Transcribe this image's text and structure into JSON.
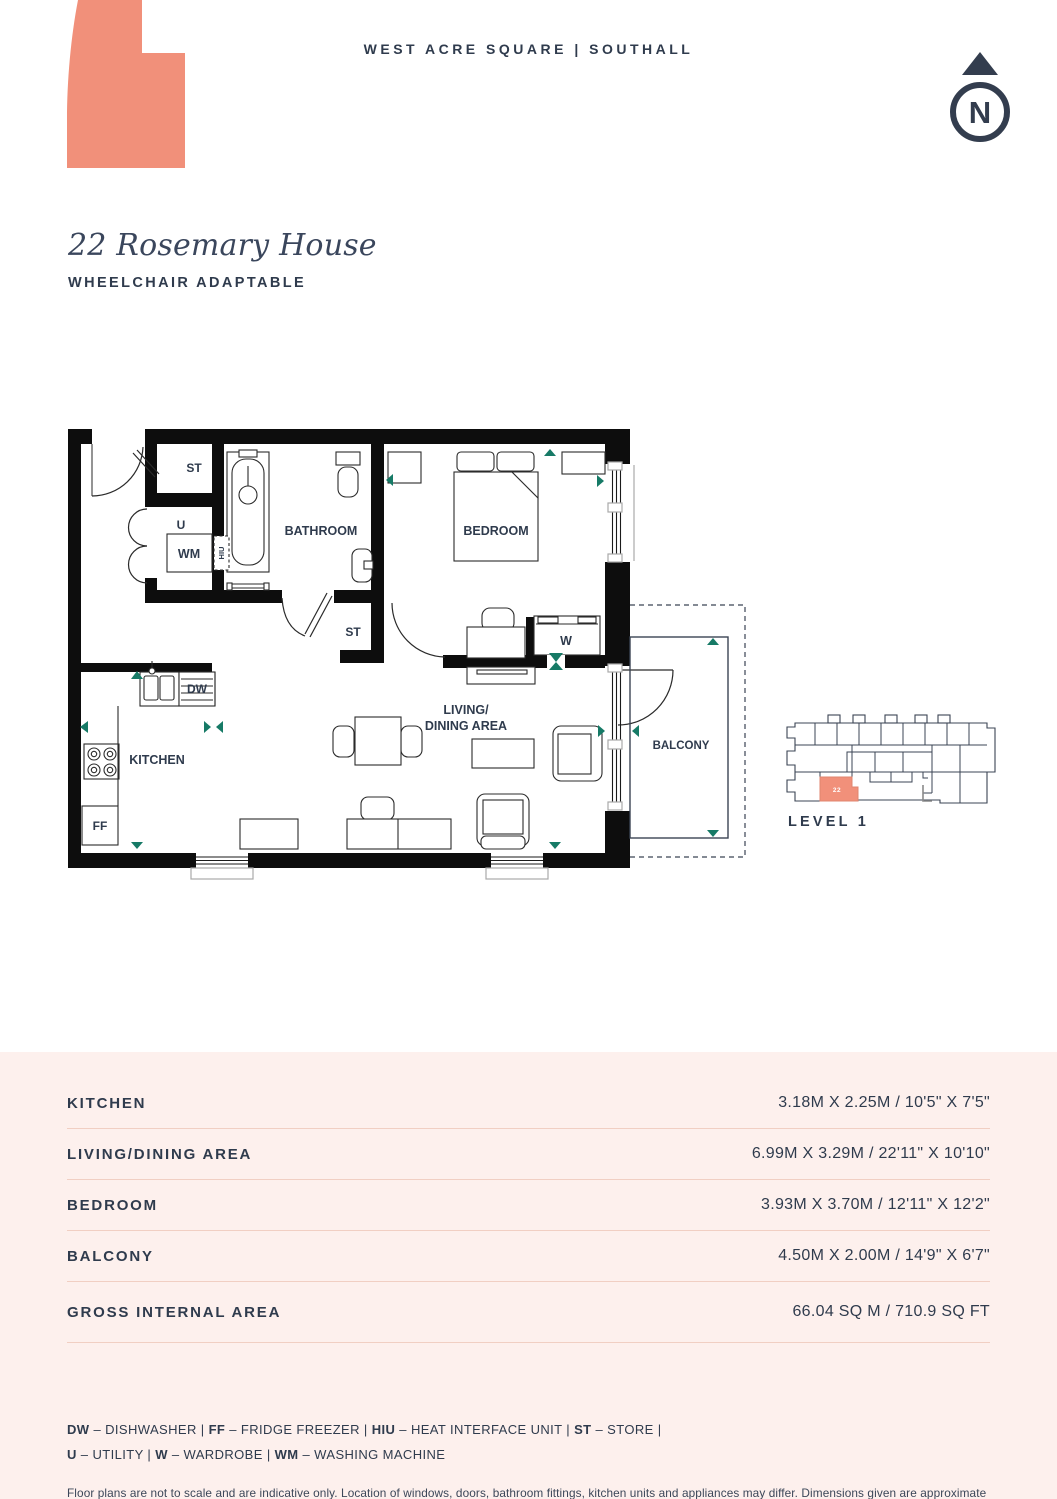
{
  "header": {
    "project": "WEST ACRE SQUARE | SOUTHALL"
  },
  "compass": {
    "n": "N"
  },
  "title": {
    "name": "22 Rosemary House",
    "subtitle": "WHEELCHAIR ADAPTABLE"
  },
  "plan": {
    "store1": "ST",
    "utility": "U",
    "wm": "WM",
    "hiu": "HIU",
    "bathroom": "BATHROOM",
    "bedroom": "BEDROOM",
    "store2": "ST",
    "wardrobe": "W",
    "dw": "DW",
    "kitchen": "KITCHEN",
    "ff": "FF",
    "living1": "LIVING/",
    "living2": "DINING AREA",
    "balcony": "BALCONY"
  },
  "locator": {
    "unit": "22",
    "level": "LEVEL 1"
  },
  "table": {
    "rows": [
      {
        "label": "KITCHEN",
        "value": "3.18M X 2.25M / 10'5\" X 7'5\""
      },
      {
        "label": "LIVING/DINING AREA",
        "value": "6.99M X 3.29M / 22'11\" X 10'10\""
      },
      {
        "label": "BEDROOM",
        "value": "3.93M X 3.70M / 12'11\" X 12'2\""
      },
      {
        "label": "BALCONY",
        "value": "4.50M X 2.00M / 14'9\" X 6'7\""
      },
      {
        "label": "GROSS INTERNAL AREA",
        "value": "66.04 SQ M / 710.9 SQ FT"
      }
    ]
  },
  "legend": {
    "line1": [
      {
        "abbr": "DW",
        "rest": " – DISHWASHER | "
      },
      {
        "abbr": "FF",
        "rest": " – FRIDGE FREEZER | "
      },
      {
        "abbr": "HIU",
        "rest": " – HEAT INTERFACE UNIT | "
      },
      {
        "abbr": "ST",
        "rest": " – STORE |"
      }
    ],
    "line2": [
      {
        "abbr": "U",
        "rest": " – UTILITY | "
      },
      {
        "abbr": "W",
        "rest": " – WARDROBE | "
      },
      {
        "abbr": "WM",
        "rest": " – WASHING MACHINE"
      }
    ]
  },
  "disclaimer": "Floor plans are not to scale and are indicative only. Location of windows, doors, bathroom fittings, kitchen units and appliances may differ. Dimensions given are approximate and should not be used to order carpets or furniture. External area sizes and locations may differ from those illustrated.",
  "colors": {
    "navy": "#2f3b4d",
    "teal": "#167a66",
    "coral": "#f1907a",
    "panel_pink": "#fdf0ed"
  }
}
